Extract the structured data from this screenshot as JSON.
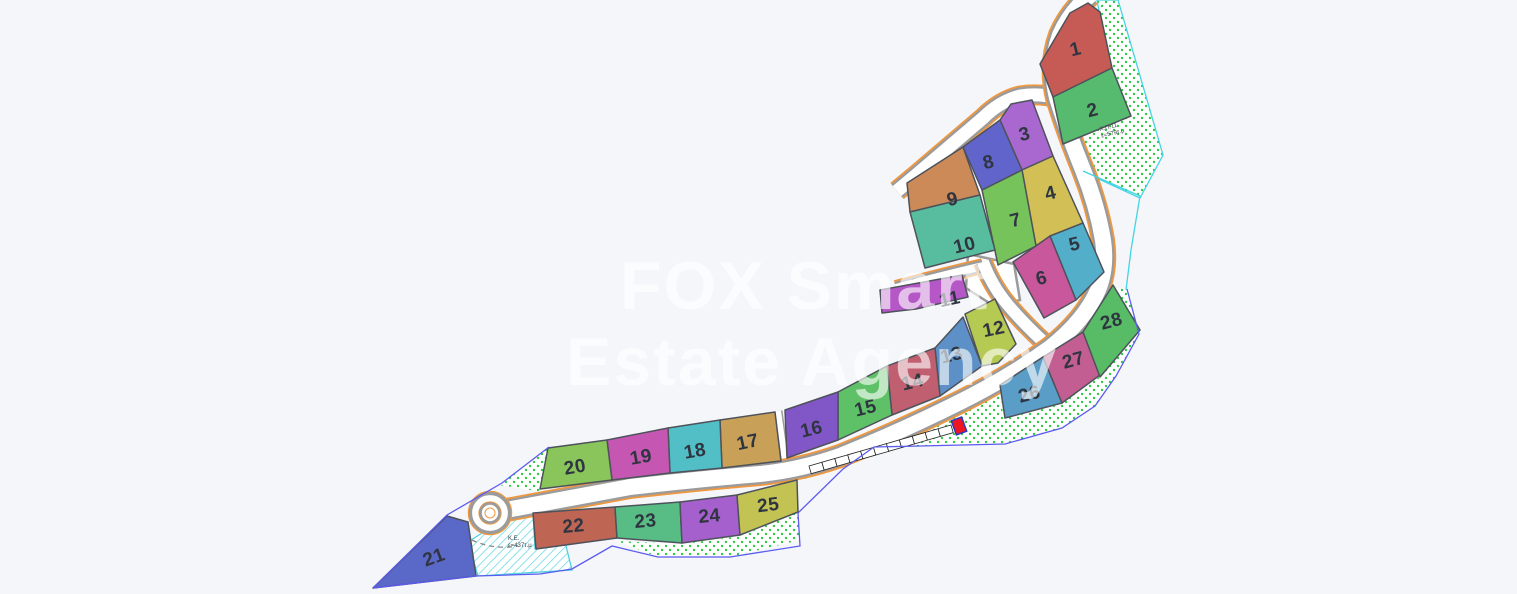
{
  "watermark": {
    "line1": "FOX Smart",
    "line2": "Estate Agency"
  },
  "map": {
    "background": "#f5f6f9",
    "colors": {
      "road_fill": "#ffffff",
      "road_casing": "#9b9b9b",
      "road_edge_orange": "#ef9840",
      "plot_stroke": "#4d525b",
      "number_color": "#2f3540",
      "dot_green": "#2ecc44",
      "hatch_cyan": "#6fdce6",
      "boundary_blue": "#5b5bf0",
      "boundary_cyan": "#44d4e4",
      "marker_fill": "#ee1522",
      "marker_stroke": "#2a35c8",
      "area_label_color": "#3a3f47"
    },
    "plots": [
      {
        "number": "1",
        "color": "#c65a55",
        "points": "1040,64 1070,13 1088,3 1100,12 1112,68 1053,97",
        "label": {
          "x": 1077,
          "y": 55,
          "rot": -14
        }
      },
      {
        "number": "2",
        "color": "#56bb6f",
        "points": "1053,97 1112,68 1131,116 1063,144",
        "label": {
          "x": 1094,
          "y": 116,
          "rot": -14
        }
      },
      {
        "number": "3",
        "color": "#a868cf",
        "points": "1000,120 1011,104 1032,100 1053,156 1022,170",
        "label": {
          "x": 1026,
          "y": 140,
          "rot": -14
        }
      },
      {
        "number": "4",
        "color": "#d2bf55",
        "points": "1022,170 1053,156 1083,223 1036,246",
        "label": {
          "x": 1052,
          "y": 199,
          "rot": -14
        }
      },
      {
        "number": "5",
        "color": "#53aec9",
        "points": "1050,236 1083,223 1104,272 1076,300",
        "label": {
          "x": 1076,
          "y": 250,
          "rot": -14
        }
      },
      {
        "number": "6",
        "color": "#c9579b",
        "points": "1013,262 1050,236 1076,300 1044,318",
        "label": {
          "x": 1043,
          "y": 284,
          "rot": -14
        }
      },
      {
        "number": "7",
        "color": "#77c35b",
        "points": "982,190 1022,170 1036,246 998,265",
        "label": {
          "x": 1017,
          "y": 226,
          "rot": -14
        }
      },
      {
        "number": "8",
        "color": "#6165cb",
        "points": "963,147 1000,120 1022,170 982,190",
        "label": {
          "x": 990,
          "y": 168,
          "rot": -14
        }
      },
      {
        "number": "9",
        "color": "#cc8a59",
        "points": "907,183 963,147 980,195 910,212",
        "label": {
          "x": 954,
          "y": 205,
          "rot": -14
        }
      },
      {
        "number": "10",
        "color": "#58bd9e",
        "points": "910,212 980,195 995,250 925,268",
        "label": {
          "x": 966,
          "y": 251,
          "rot": -14
        }
      },
      {
        "number": "11",
        "color": "#b657c8",
        "points": "880,290 962,275 968,297 916,309 882,313",
        "label": {
          "x": 951,
          "y": 305,
          "rot": -12
        }
      },
      {
        "number": "12",
        "color": "#b5ca52",
        "points": "965,314 995,299 1016,344 998,363 982,366",
        "label": {
          "x": 995,
          "y": 335,
          "rot": -12
        }
      },
      {
        "number": "13",
        "color": "#5d90c6",
        "points": "935,348 963,317 982,366 940,396",
        "label": {
          "x": 953,
          "y": 361,
          "rot": -14
        }
      },
      {
        "number": "14",
        "color": "#bf5f70",
        "points": "887,366 935,348 940,396 892,415",
        "label": {
          "x": 914,
          "y": 388,
          "rot": -14
        }
      },
      {
        "number": "15",
        "color": "#5fc167",
        "points": "838,392 887,366 892,415 838,440",
        "label": {
          "x": 867,
          "y": 414,
          "rot": -14
        }
      },
      {
        "number": "16",
        "color": "#8156c6",
        "points": "785,410 838,392 838,440 787,458",
        "label": {
          "x": 813,
          "y": 435,
          "rot": -14
        }
      },
      {
        "number": "17",
        "color": "#c8a058",
        "points": "720,420 775,412 781,461 722,468",
        "label": {
          "x": 749,
          "y": 448,
          "rot": -12
        }
      },
      {
        "number": "18",
        "color": "#52bfc7",
        "points": "668,428 720,420 722,468 670,473",
        "label": {
          "x": 696,
          "y": 457,
          "rot": -10
        }
      },
      {
        "number": "19",
        "color": "#c557b3",
        "points": "607,440 668,428 670,473 612,480",
        "label": {
          "x": 642,
          "y": 463,
          "rot": -10
        }
      },
      {
        "number": "20",
        "color": "#8ac55b",
        "points": "548,448 607,440 612,480 540,489",
        "label": {
          "x": 576,
          "y": 473,
          "rot": -10
        }
      },
      {
        "number": "21",
        "color": "#5a68c7",
        "points": "373,588 447,516 468,522 476,576",
        "label": {
          "x": 436,
          "y": 563,
          "rot": -20
        }
      },
      {
        "number": "22",
        "color": "#bf6554",
        "points": "533,513 615,507 617,538 536,549",
        "label": {
          "x": 574,
          "y": 532,
          "rot": -5
        }
      },
      {
        "number": "23",
        "color": "#58bd84",
        "points": "615,507 680,502 682,543 617,538",
        "label": {
          "x": 646,
          "y": 527,
          "rot": -5
        }
      },
      {
        "number": "24",
        "color": "#a660ce",
        "points": "680,502 737,495 740,535 682,543",
        "label": {
          "x": 710,
          "y": 522,
          "rot": -5
        }
      },
      {
        "number": "25",
        "color": "#c2c353",
        "points": "737,495 797,480 798,512 740,535",
        "label": {
          "x": 769,
          "y": 511,
          "rot": -7
        }
      },
      {
        "number": "26",
        "color": "#5a9dc7",
        "points": "1000,385 1043,357 1062,403 1005,418",
        "label": {
          "x": 1031,
          "y": 400,
          "rot": -15
        }
      },
      {
        "number": "27",
        "color": "#c25e92",
        "points": "1043,357 1083,332 1100,375 1062,403",
        "label": {
          "x": 1075,
          "y": 366,
          "rot": -15
        }
      },
      {
        "number": "28",
        "color": "#58bb66",
        "points": "1083,332 1113,285 1140,330 1100,377",
        "label": {
          "x": 1113,
          "y": 327,
          "rot": -15
        }
      }
    ],
    "areas": [
      {
        "name": "green-area-xp11",
        "pattern": "dots",
        "border": "#44d4e4",
        "points": "1097,0 1118,0 1163,155 1140,198 1075,168 1062,142 1130,114 1108,58"
      },
      {
        "name": "green-area-south",
        "pattern": "dots",
        "border": "none",
        "points": "798,481 850,465 875,448 920,446 1005,444 1062,428 1095,406 1116,376 1139,334 1127,289 1112,288 1138,331 1099,377 1061,404 1004,419 999,388 984,400 939,420 904,440 859,455"
      },
      {
        "name": "green-area-bottom-strip",
        "pattern": "dots",
        "border": "none",
        "points": "617,541 682,544 740,536 797,513 800,540 730,557 658,557"
      },
      {
        "name": "green-area-roundabout",
        "pattern": "dots",
        "border": "none",
        "points": "499,485 549,447 543,492"
      },
      {
        "name": "hatch-area-ke",
        "pattern": "hatch",
        "border": "#4fd0e0",
        "points": "468,542 512,514 533,513 535,549 565,542 572,570 478,576"
      }
    ],
    "culdesac_head": {
      "points": "968,254 1014,264 1020,300 994,306 966,288"
    },
    "roads": [
      {
        "name": "alley-10-11",
        "path": "M983,266 Q940,276 896,288",
        "width": 8
      },
      {
        "name": "spur-road",
        "path": "M1047,345 Q1025,325 1008,305 Q992,286 983,262",
        "width": 12
      },
      {
        "name": "loop-road",
        "path": "M1057,98 Q1040,93 1020,96 Q1000,101 983,118 Q950,146 915,176 L897,191",
        "width": 13
      },
      {
        "name": "main-road",
        "path": "M490,513 Q560,500 630,487 Q700,479 760,474 Q800,470 840,456 Q900,432 960,402 Q1010,377 1050,348 Q1085,320 1098,290 Q1107,268 1103,240 Q1097,205 1083,170 Q1068,133 1057,98 Q1049,65 1060,35 Q1070,12 1090,-5",
        "width": 16
      }
    ],
    "footpaths": [
      {
        "name": "footpath-8-9",
        "path": "M967,148 L999,250",
        "width": 6
      },
      {
        "name": "footpath-16-17",
        "path": "M778,411 L785,461",
        "width": 6
      }
    ],
    "roundabout": {
      "cx": 490,
      "cy": 513,
      "outer_edge_r": 21.5,
      "casing_r": 19.5,
      "island_edge_r": 11,
      "island_r": 9.5,
      "island_core_r": 5
    },
    "dashed_arc": {
      "path": "M464,536 Q490,551 518,546"
    },
    "parking_row": {
      "x1": 809,
      "y1": 466,
      "x2": 951,
      "y2": 425,
      "cells": 11,
      "depth": 8
    },
    "marker": {
      "x": 959,
      "y": 426,
      "w": 11,
      "h": 15,
      "rot": -20
    },
    "boundaries": [
      {
        "name": "boundary-sw-upper",
        "color": "#5b5bf0",
        "points": "373,588 447,515 502,483 549,447"
      },
      {
        "name": "boundary-south",
        "color": "#5b5bf0",
        "points": "373,588 476,576 540,574 572,569 612,546 658,557 730,557 800,546 798,513 843,469 874,447 920,446 1005,444 1062,428 1095,406 1116,376 1139,334 1127,289"
      },
      {
        "name": "boundary-ne-cyan",
        "color": "#44d4e4",
        "points": "1083,171 1140,196 1131,250 1126,290"
      }
    ],
    "area_labels": [
      {
        "name": "label-xp11",
        "lines": [
          "Χ.Π.11",
          "ε=579τ.μ"
        ],
        "x": 1100,
        "y": 131,
        "rot": -14
      },
      {
        "name": "label-ke",
        "lines": [
          "Κ.Ε.",
          "ε=437τ.μ"
        ],
        "x": 508,
        "y": 540,
        "rot": 0
      }
    ]
  }
}
